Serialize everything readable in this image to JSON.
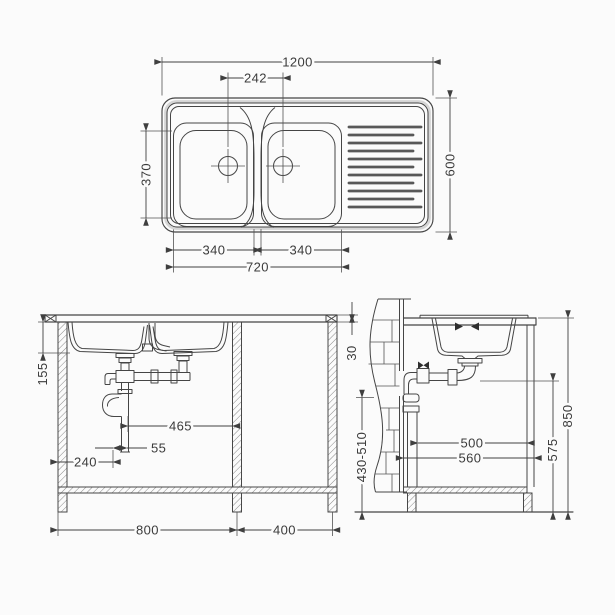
{
  "drawing": {
    "subject": "double-bowl-sink-technical-drawing",
    "views": {
      "plan": "plan-view",
      "front": "front-section-view",
      "side": "side-section-view"
    }
  },
  "dimensions": {
    "plan": {
      "overall_length": "1200",
      "drain_spacing": "242",
      "bowl_width": "370",
      "overall_depth": "600",
      "bowl1_length": "340",
      "bowl2_length": "340",
      "bowls_length": "720"
    },
    "front": {
      "bowl_depth": "155",
      "trap_to_partition": "465",
      "trap_offset": "55",
      "trap_from_side": "240",
      "cabinet1_width": "800",
      "cabinet2_width": "400"
    },
    "side": {
      "worktop_thickness": "30",
      "outlet_height_range": "430-510",
      "inner_depth": "500",
      "overall_depth": "560",
      "pipe_height": "575",
      "worktop_height": "850"
    }
  },
  "colors": {
    "background": "#fbfbfb",
    "line": "#454545",
    "rim_shade": "#d6d6d6",
    "text": "#3b3b3b"
  }
}
